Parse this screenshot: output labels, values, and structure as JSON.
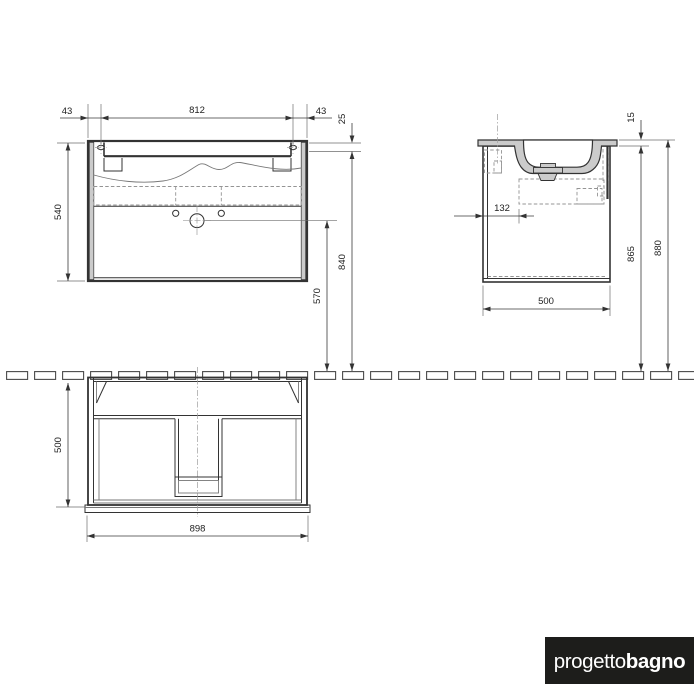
{
  "views": {
    "front": {
      "edge_left": "43",
      "hole_spacing": "812",
      "edge_right": "43",
      "rail_offset": "25",
      "cabinet_height": "540",
      "rail_height": "840",
      "drain_height": "570"
    },
    "side": {
      "top_thickness": "15",
      "front_clearance": "132",
      "underside_height": "865",
      "overall_height": "880",
      "depth": "500"
    },
    "plan": {
      "depth": "500",
      "width": "898"
    }
  },
  "logo": {
    "regular": "progetto",
    "bold": "bagno"
  },
  "colors": {
    "line": "#333333",
    "fill_gray": "#cbcbcb",
    "hidden_line": "#949494",
    "logo_bg": "#1d1d1b",
    "logo_text": "#ffffff"
  }
}
